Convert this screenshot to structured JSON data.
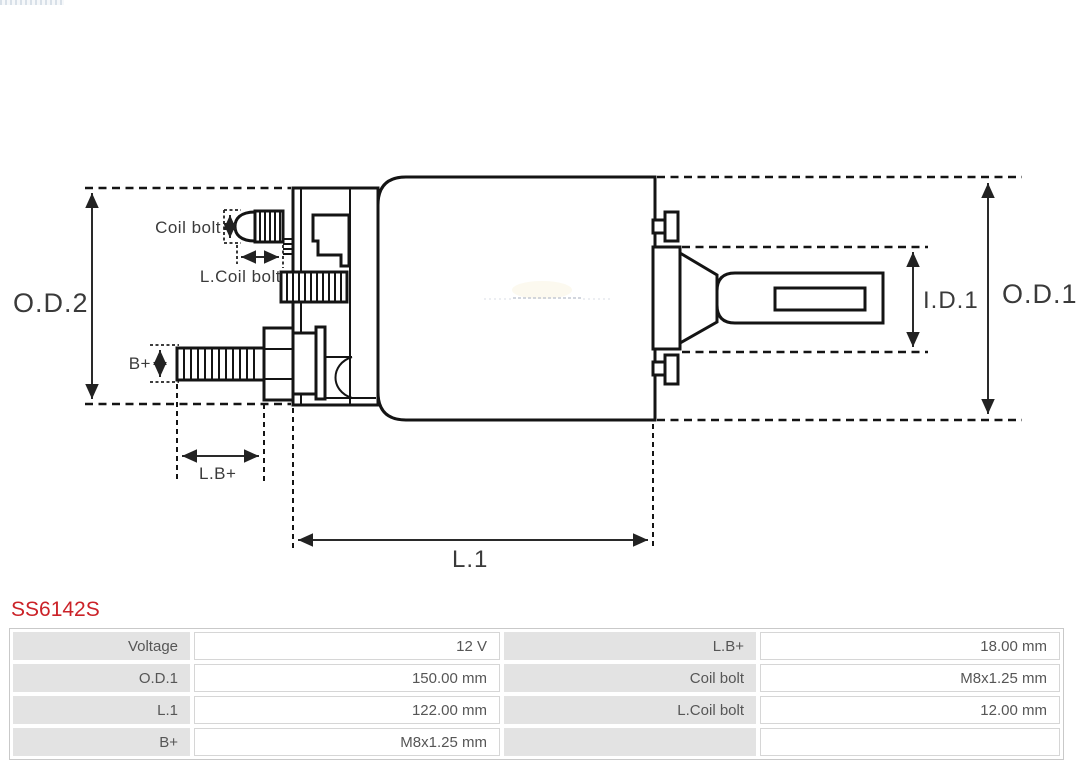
{
  "part_number": "SS6142S",
  "diagram": {
    "labels": {
      "od2": "O.D.2",
      "od1": "O.D.1",
      "id1": "I.D.1",
      "l1": "L.1",
      "coil_bolt": "Coil bolt",
      "l_coil_bolt": "L.Coil bolt",
      "b_plus": "B+",
      "lb_plus": "L.B+"
    }
  },
  "spec_table": {
    "rows": [
      {
        "cells": [
          {
            "label": "Voltage",
            "value": "12 V"
          },
          {
            "label": "L.B+",
            "value": "18.00 mm"
          }
        ]
      },
      {
        "cells": [
          {
            "label": "O.D.1",
            "value": "150.00 mm"
          },
          {
            "label": "Coil bolt",
            "value": "M8x1.25 mm"
          }
        ]
      },
      {
        "cells": [
          {
            "label": "L.1",
            "value": "122.00 mm"
          },
          {
            "label": "L.Coil bolt",
            "value": "12.00 mm"
          }
        ]
      },
      {
        "cells": [
          {
            "label": "B+",
            "value": "M8x1.25 mm"
          },
          {
            "label": "",
            "value": ""
          }
        ]
      }
    ]
  },
  "colors": {
    "part_number_red": "#cb2228",
    "diagram_line": "#141414",
    "table_label_bg": "#e3e3e3",
    "table_text": "#565656",
    "table_border": "#c9c9c9"
  }
}
